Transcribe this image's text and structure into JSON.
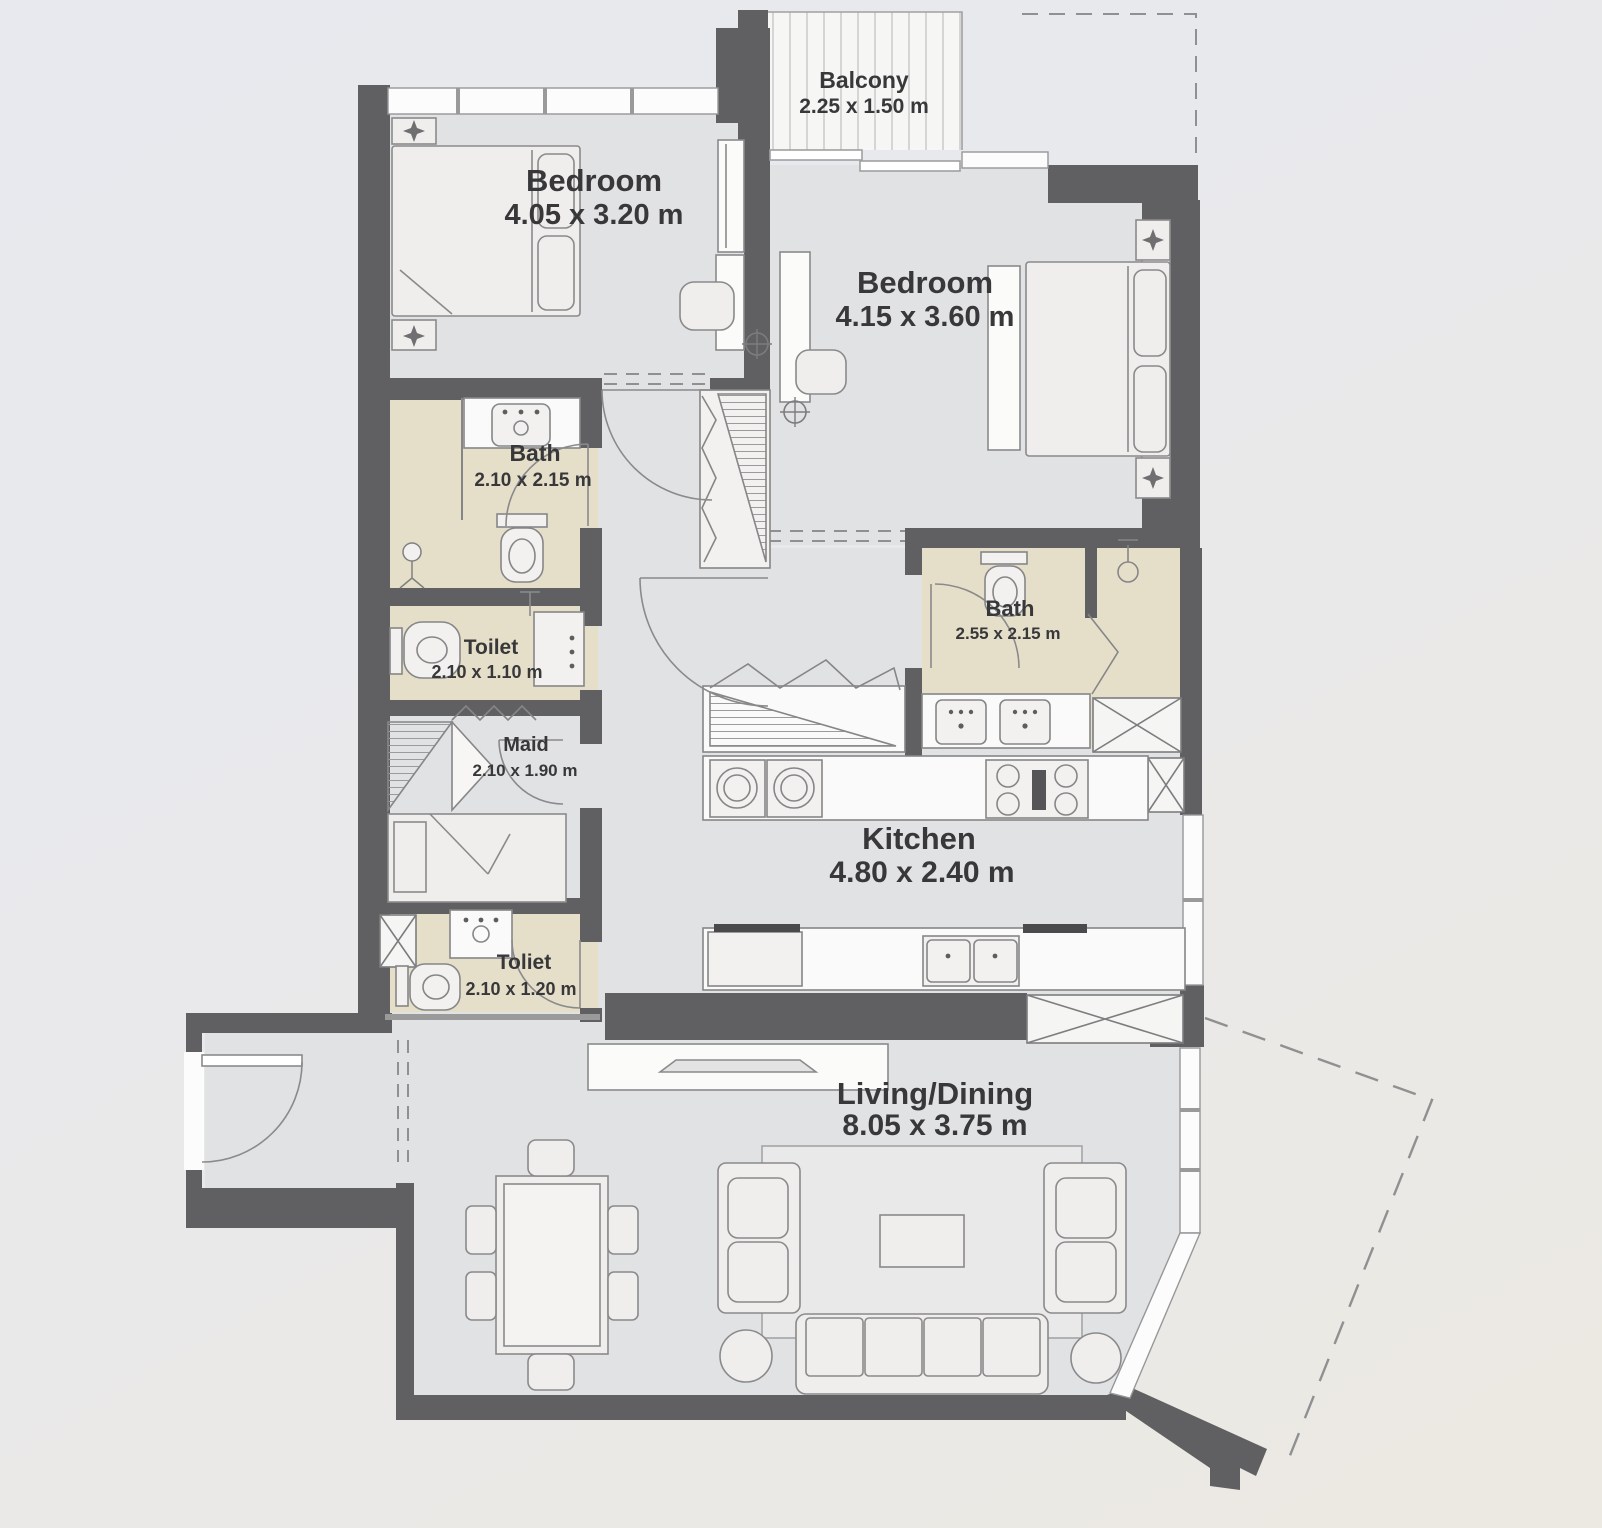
{
  "plan": {
    "rooms": [
      {
        "id": "bedroom-1",
        "name": "Bedroom",
        "dims": "4.05 x 3.20 m"
      },
      {
        "id": "bedroom-2",
        "name": "Bedroom",
        "dims": "4.15 x 3.60 m"
      },
      {
        "id": "balcony",
        "name": "Balcony",
        "dims": "2.25 x 1.50 m"
      },
      {
        "id": "bath-1",
        "name": "Bath",
        "dims": "2.10 x 2.15 m"
      },
      {
        "id": "toilet-1",
        "name": "Toilet",
        "dims": "2.10 x 1.10 m"
      },
      {
        "id": "maid",
        "name": "Maid",
        "dims": "2.10 x 1.90 m"
      },
      {
        "id": "toilet-2",
        "name": "Toliet",
        "dims": "2.10 x 1.20 m"
      },
      {
        "id": "bath-2",
        "name": "Bath",
        "dims": "2.55 x 2.15 m"
      },
      {
        "id": "kitchen",
        "name": "Kitchen",
        "dims": "4.80 x 2.40 m"
      },
      {
        "id": "living-dining",
        "name": "Living/Dining",
        "dims": "8.05 x 3.75 m"
      }
    ],
    "colors": {
      "wall": "#606062",
      "floor": "#e1e2e4",
      "bath_floor": "#e5dfca",
      "counter": "#fafafa",
      "label_text": "#38383a",
      "background_top": "#e7e9ee",
      "background_bottom": "#ece9e2"
    }
  }
}
